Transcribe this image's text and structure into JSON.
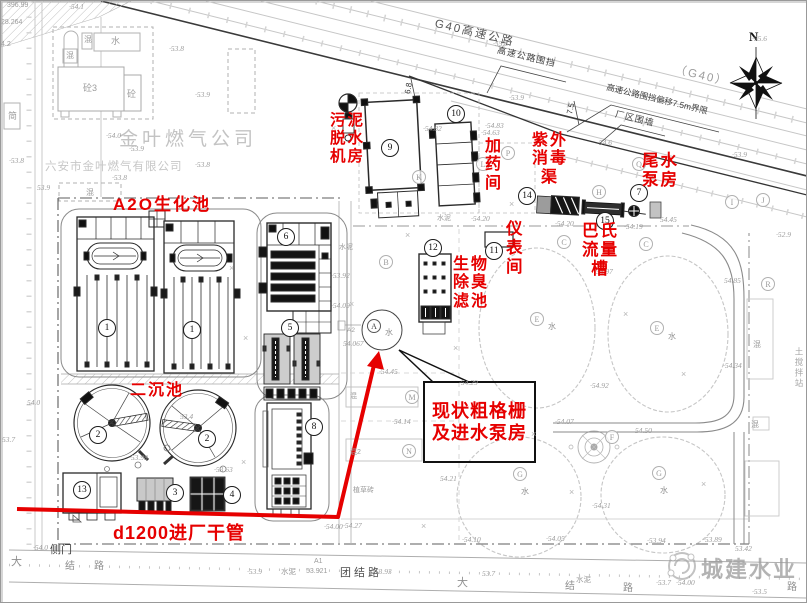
{
  "compass": {
    "label": "N"
  },
  "highway": {
    "name": "G40高速公路",
    "name_paren": "（G40）",
    "fence_label": "高速公路围挡",
    "offset_label": "高速公路围挡偏移7.5m界限",
    "wall_label": "厂区围墙",
    "offset_dim": "7.5",
    "dim2": "6.8"
  },
  "company": {
    "name": "金叶燃气公司",
    "full_name": "六安市金叶燃气有限公司"
  },
  "pipe": {
    "label": "d1200进厂干管"
  },
  "roads": {
    "tuanjie": "团结路",
    "side_gate": "侧门"
  },
  "callout": {
    "line1": "现状粗格栅",
    "line2": "及进水泵房"
  },
  "watermark": {
    "text": "城建水业"
  },
  "red_labels": [
    {
      "name": "label-sludge-dewatering-room",
      "x": 329,
      "y": 111,
      "size": 15.5,
      "lines": [
        "污泥",
        "脱水",
        "机房"
      ]
    },
    {
      "name": "label-dosing-room",
      "x": 484,
      "y": 137,
      "size": 16,
      "lines": [
        "加",
        "药",
        "间"
      ]
    },
    {
      "name": "label-uv-disinfection-channel",
      "x": 531,
      "y": 131,
      "size": 16,
      "lines": [
        "紫外",
        "消毒",
        "渠"
      ]
    },
    {
      "name": "label-tailwater-pump-house",
      "x": 641,
      "y": 151,
      "size": 16.5,
      "lines": [
        "尾水",
        "泵房"
      ]
    },
    {
      "name": "label-a2o-biotank",
      "x": 112,
      "y": 194,
      "size": 17,
      "lines": [
        "A2O生化池"
      ]
    },
    {
      "name": "label-secondary-clarifier",
      "x": 129,
      "y": 381,
      "size": 16,
      "lines": [
        "二沉池"
      ]
    },
    {
      "name": "label-bio-deodorizing-filter",
      "x": 452,
      "y": 255,
      "size": 16,
      "lines": [
        "生物",
        "除臭",
        "滤池"
      ]
    },
    {
      "name": "label-instrument-room",
      "x": 505,
      "y": 219,
      "size": 16.5,
      "lines": [
        "仪",
        "表",
        "间"
      ]
    },
    {
      "name": "label-parshall-flume",
      "x": 581,
      "y": 221,
      "size": 16.5,
      "lines": [
        "巴氏",
        "流量",
        "槽"
      ]
    }
  ],
  "numbered_badges": [
    {
      "n": "1",
      "x": 106,
      "y": 327
    },
    {
      "n": "1",
      "x": 191,
      "y": 329
    },
    {
      "n": "2",
      "x": 97,
      "y": 434
    },
    {
      "n": "2",
      "x": 206,
      "y": 438
    },
    {
      "n": "3",
      "x": 174,
      "y": 492
    },
    {
      "n": "4",
      "x": 231,
      "y": 494
    },
    {
      "n": "5",
      "x": 289,
      "y": 327
    },
    {
      "n": "6",
      "x": 285,
      "y": 236
    },
    {
      "n": "7",
      "x": 638,
      "y": 192
    },
    {
      "n": "8",
      "x": 313,
      "y": 426
    },
    {
      "n": "9",
      "x": 389,
      "y": 147
    },
    {
      "n": "10",
      "x": 455,
      "y": 113
    },
    {
      "n": "11",
      "x": 493,
      "y": 250
    },
    {
      "n": "12",
      "x": 432,
      "y": 247
    },
    {
      "n": "13",
      "x": 81,
      "y": 489
    },
    {
      "n": "14",
      "x": 526,
      "y": 195
    },
    {
      "n": "15",
      "x": 604,
      "y": 220
    }
  ],
  "letter_badges": [
    {
      "ch": "A",
      "x": 373,
      "y": 325,
      "dark": true
    },
    {
      "ch": "B",
      "x": 385,
      "y": 261
    },
    {
      "ch": "K",
      "x": 418,
      "y": 176
    },
    {
      "ch": "L",
      "x": 482,
      "y": 163
    },
    {
      "ch": "P",
      "x": 507,
      "y": 152
    },
    {
      "ch": "Q",
      "x": 638,
      "y": 163
    },
    {
      "ch": "H",
      "x": 598,
      "y": 191
    },
    {
      "ch": "C",
      "x": 563,
      "y": 241
    },
    {
      "ch": "C",
      "x": 645,
      "y": 243
    },
    {
      "ch": "E",
      "x": 536,
      "y": 318
    },
    {
      "ch": "E",
      "x": 656,
      "y": 327
    },
    {
      "ch": "G",
      "x": 519,
      "y": 473
    },
    {
      "ch": "G",
      "x": 658,
      "y": 472
    },
    {
      "ch": "M",
      "x": 411,
      "y": 396
    },
    {
      "ch": "N",
      "x": 408,
      "y": 450
    },
    {
      "ch": "F",
      "x": 611,
      "y": 436
    },
    {
      "ch": "I",
      "x": 731,
      "y": 201
    },
    {
      "ch": "J",
      "x": 762,
      "y": 199
    },
    {
      "ch": "R",
      "x": 767,
      "y": 283
    }
  ],
  "water_marks": [
    {
      "t": "水",
      "x": 547,
      "y": 320
    },
    {
      "t": "水",
      "x": 667,
      "y": 330
    },
    {
      "t": "水",
      "x": 520,
      "y": 485
    },
    {
      "t": "水",
      "x": 659,
      "y": 484
    },
    {
      "t": "水",
      "x": 384,
      "y": 326
    }
  ],
  "elevations": [
    {
      "t": "·54.1",
      "x": 68,
      "y": 1
    },
    {
      "t": "·55.6",
      "x": 492,
      "y": 38
    },
    {
      "t": "·55.6",
      "x": 751,
      "y": 33
    },
    {
      "t": "·53.9",
      "x": 508,
      "y": 92
    },
    {
      "t": "·53.9",
      "x": 731,
      "y": 149
    },
    {
      "t": "·54.83",
      "x": 484,
      "y": 120
    },
    {
      "t": "·54.6",
      "x": 596,
      "y": 137
    },
    {
      "t": "·54.82",
      "x": 422,
      "y": 123
    },
    {
      "t": "·54.63",
      "x": 480,
      "y": 127
    },
    {
      "t": "·54.20",
      "x": 470,
      "y": 213
    },
    {
      "t": "·54.20",
      "x": 554,
      "y": 218
    },
    {
      "t": "·54.19",
      "x": 623,
      "y": 221
    },
    {
      "t": "54.45",
      "x": 659,
      "y": 214
    },
    {
      "t": "54.97",
      "x": 595,
      "y": 266
    },
    {
      "t": "54.85",
      "x": 723,
      "y": 275
    },
    {
      "t": "·54.34",
      "x": 722,
      "y": 360
    },
    {
      "t": "·52.9",
      "x": 775,
      "y": 229
    },
    {
      "t": "·53.8",
      "x": 168,
      "y": 43
    },
    {
      "t": "·53.9",
      "x": 194,
      "y": 89
    },
    {
      "t": "·54.0",
      "x": 105,
      "y": 130
    },
    {
      "t": "·53.9",
      "x": 128,
      "y": 143
    },
    {
      "t": "·53.8",
      "x": 8,
      "y": 155
    },
    {
      "t": "·53.8",
      "x": 194,
      "y": 159
    },
    {
      "t": "·53.8",
      "x": 111,
      "y": 172
    },
    {
      "t": "53.9",
      "x": 36,
      "y": 182
    },
    {
      "t": "·53.92",
      "x": 330,
      "y": 270
    },
    {
      "t": "·54.09",
      "x": 330,
      "y": 300
    },
    {
      "t": "·53.98",
      "x": 128,
      "y": 452
    },
    {
      "t": "·53.63",
      "x": 213,
      "y": 464
    },
    {
      "t": "53.4",
      "x": 179,
      "y": 411
    },
    {
      "t": "·54.45",
      "x": 378,
      "y": 366
    },
    {
      "t": "·54.29",
      "x": 458,
      "y": 377
    },
    {
      "t": "·54.14",
      "x": 391,
      "y": 416
    },
    {
      "t": "·54.92",
      "x": 589,
      "y": 380
    },
    {
      "t": "·54.07",
      "x": 554,
      "y": 416
    },
    {
      "t": "54.50",
      "x": 634,
      "y": 425
    },
    {
      "t": "54.21",
      "x": 439,
      "y": 473
    },
    {
      "t": "·54.31",
      "x": 591,
      "y": 500
    },
    {
      "t": "54.0",
      "x": 26,
      "y": 397
    },
    {
      "t": "53.7",
      "x": 1,
      "y": 434
    },
    {
      "t": "·54.0",
      "x": 32,
      "y": 542
    },
    {
      "t": "·53.9",
      "x": 246,
      "y": 566
    },
    {
      "t": "·53.93",
      "x": 372,
      "y": 566
    },
    {
      "t": "·54.10",
      "x": 461,
      "y": 534
    },
    {
      "t": "·54.05",
      "x": 545,
      "y": 533
    },
    {
      "t": "·54.00",
      "x": 323,
      "y": 521
    },
    {
      "t": "·54.27",
      "x": 342,
      "y": 520
    },
    {
      "t": "53.7",
      "x": 481,
      "y": 568
    },
    {
      "t": "·53.94",
      "x": 646,
      "y": 535
    },
    {
      "t": "·53.89",
      "x": 702,
      "y": 534
    },
    {
      "t": "53.42",
      "x": 734,
      "y": 543
    },
    {
      "t": "·53.7",
      "x": 655,
      "y": 577
    },
    {
      "t": "·54.00",
      "x": 675,
      "y": 577
    },
    {
      "t": "·53.5",
      "x": 751,
      "y": 586
    },
    {
      "t": "54.067",
      "x": 342,
      "y": 338
    }
  ],
  "small_texts": [
    {
      "t": "砼3",
      "x": 82,
      "y": 80,
      "s": 9
    },
    {
      "t": "砼",
      "x": 126,
      "y": 86,
      "s": 9
    },
    {
      "t": "水",
      "x": 110,
      "y": 33,
      "s": 9
    },
    {
      "t": "混",
      "x": 83,
      "y": 33,
      "s": 8
    },
    {
      "t": "混",
      "x": 65,
      "y": 49,
      "s": 8
    },
    {
      "t": "混",
      "x": 85,
      "y": 186,
      "s": 8
    },
    {
      "t": "简",
      "x": 7,
      "y": 108,
      "s": 9
    },
    {
      "t": "水泥",
      "x": 436,
      "y": 212,
      "s": 7
    },
    {
      "t": "水泥",
      "x": 280,
      "y": 565,
      "s": 7.5
    },
    {
      "t": "水泥",
      "x": 575,
      "y": 573,
      "s": 7.5
    },
    {
      "t": "水泥",
      "x": 338,
      "y": 241,
      "s": 7
    },
    {
      "t": "植草砖",
      "x": 352,
      "y": 484,
      "s": 7
    },
    {
      "t": "混",
      "x": 752,
      "y": 338,
      "s": 8
    },
    {
      "t": "混",
      "x": 750,
      "y": 418,
      "s": 8
    },
    {
      "t": "土搅拌站",
      "x": 792,
      "y": 346,
      "s": 8.5,
      "cls": "v"
    },
    {
      "t": "大",
      "x": 10,
      "y": 552,
      "s": 11,
      "cls": "rd"
    },
    {
      "t": "结",
      "x": 64,
      "y": 556,
      "s": 10,
      "cls": "rd"
    },
    {
      "t": "路",
      "x": 93,
      "y": 556,
      "s": 10,
      "cls": "rd"
    },
    {
      "t": "大",
      "x": 456,
      "y": 573,
      "s": 11,
      "cls": "rd"
    },
    {
      "t": "结",
      "x": 564,
      "y": 576,
      "s": 10,
      "cls": "rd"
    },
    {
      "t": "路",
      "x": 786,
      "y": 577,
      "s": 10,
      "cls": "rd"
    },
    {
      "t": "路",
      "x": 622,
      "y": 578,
      "s": 10,
      "cls": "rd"
    },
    {
      "t": "396.99",
      "x": 6,
      "y": 1,
      "s": 7
    },
    {
      "t": "28.264",
      "x": 0,
      "y": 18,
      "s": 7
    },
    {
      "t": "4.2",
      "x": 0,
      "y": 40,
      "s": 7
    },
    {
      "t": "A2",
      "x": 346,
      "y": 326,
      "s": 6.5
    },
    {
      "t": "A1",
      "x": 313,
      "y": 557,
      "s": 7
    },
    {
      "t": "53.921",
      "x": 305,
      "y": 567,
      "s": 7
    },
    {
      "t": "混2",
      "x": 349,
      "y": 446,
      "s": 7
    },
    {
      "t": "混",
      "x": 349,
      "y": 390,
      "s": 7
    },
    {
      "t": "×",
      "x": 228,
      "y": 262,
      "s": 9,
      "cls": "xm"
    },
    {
      "t": "×",
      "x": 242,
      "y": 332,
      "s": 9,
      "cls": "xm"
    },
    {
      "t": "×",
      "x": 240,
      "y": 456,
      "s": 9,
      "cls": "xm"
    },
    {
      "t": "×",
      "x": 348,
      "y": 298,
      "s": 9,
      "cls": "xm"
    },
    {
      "t": "×",
      "x": 404,
      "y": 229,
      "s": 9,
      "cls": "xm"
    },
    {
      "t": "×",
      "x": 452,
      "y": 342,
      "s": 9,
      "cls": "xm"
    },
    {
      "t": "×",
      "x": 530,
      "y": 428,
      "s": 9,
      "cls": "xm"
    },
    {
      "t": "×",
      "x": 622,
      "y": 308,
      "s": 9,
      "cls": "xm"
    },
    {
      "t": "×",
      "x": 680,
      "y": 368,
      "s": 9,
      "cls": "xm"
    },
    {
      "t": "×",
      "x": 700,
      "y": 478,
      "s": 9,
      "cls": "xm"
    },
    {
      "t": "×",
      "x": 330,
      "y": 122,
      "s": 9,
      "cls": "xm"
    },
    {
      "t": "×",
      "x": 508,
      "y": 198,
      "s": 9,
      "cls": "xm"
    },
    {
      "t": "×",
      "x": 568,
      "y": 486,
      "s": 9,
      "cls": "xm"
    },
    {
      "t": "×",
      "x": 420,
      "y": 520,
      "s": 9,
      "cls": "xm"
    }
  ]
}
